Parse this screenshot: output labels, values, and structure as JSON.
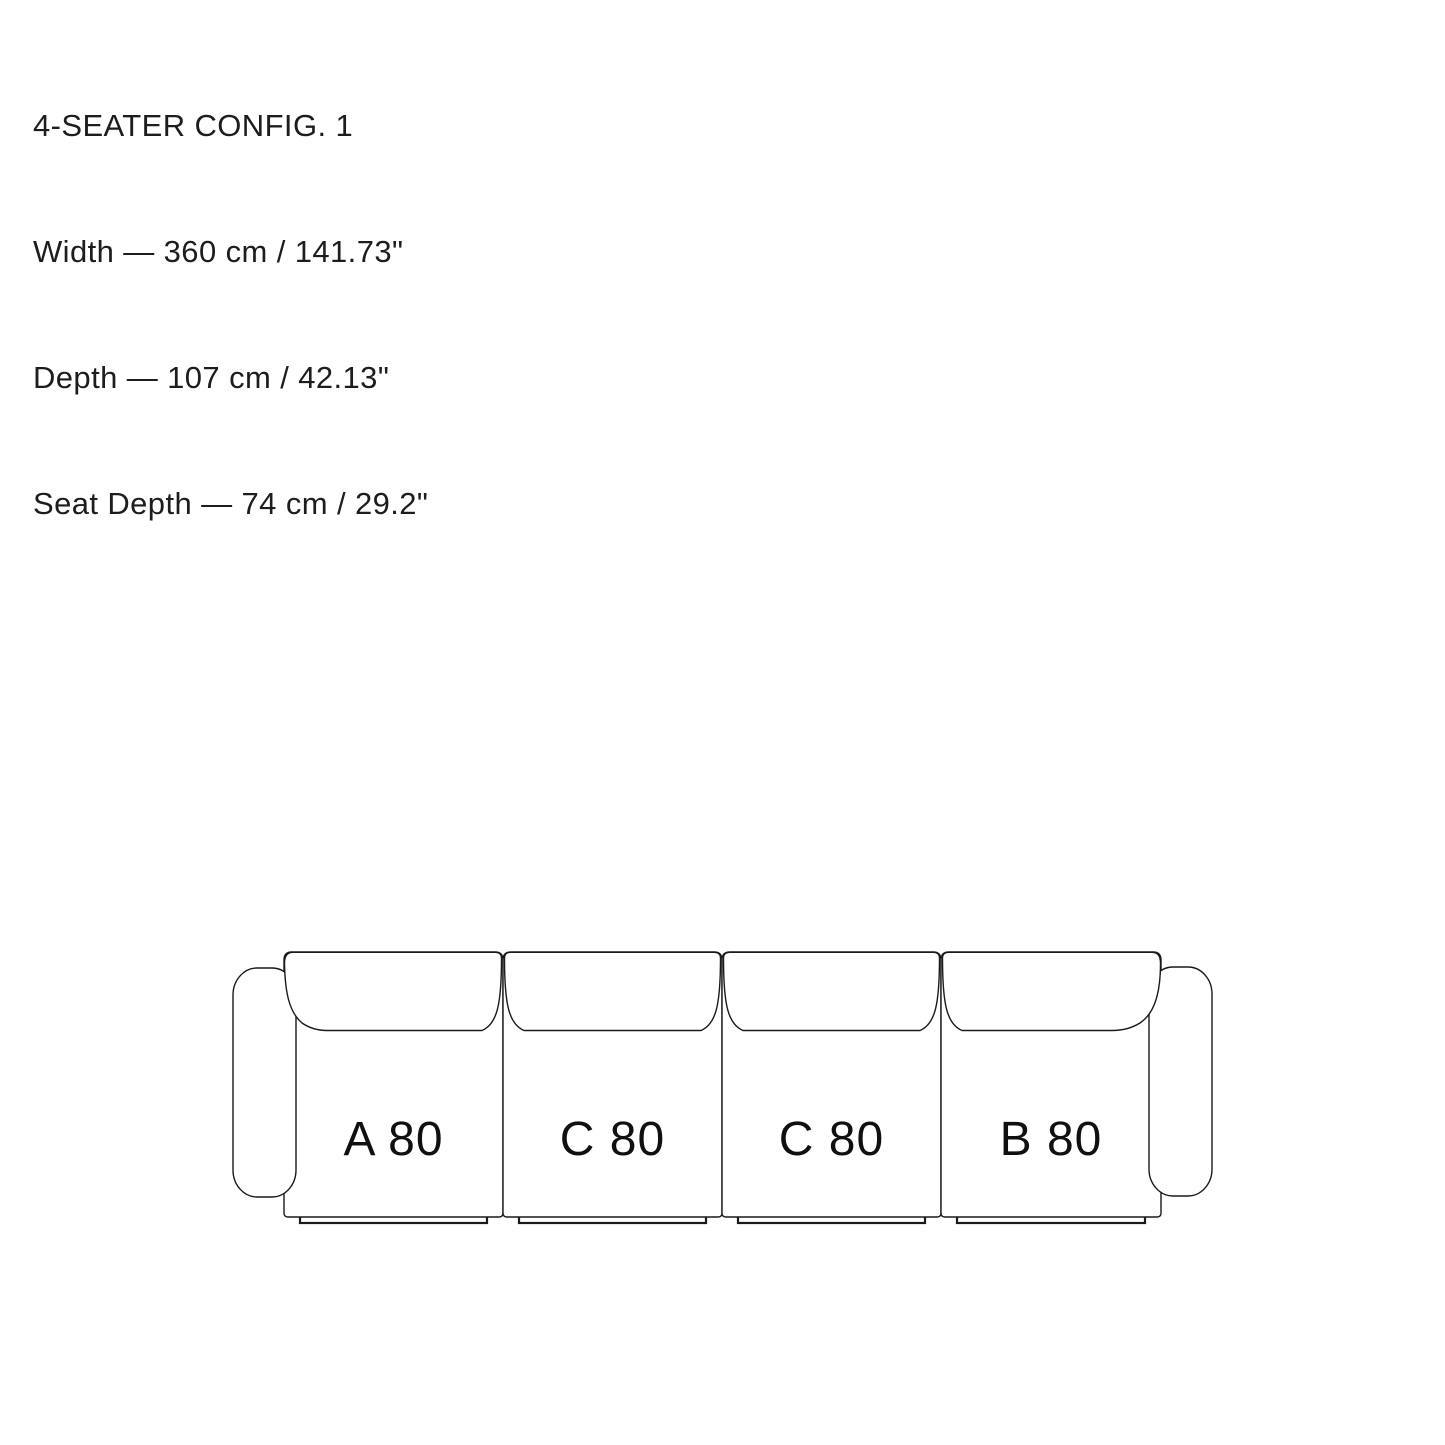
{
  "colors": {
    "background": "#ffffff",
    "line": "#1a1a1a",
    "text": "#1d1d1b"
  },
  "header": {
    "title": "4-SEATER CONFIG. 1",
    "lines": [
      "Width — 360 cm / 141.73\"",
      "Depth — 107 cm / 42.13\"",
      "Seat Depth — 74 cm / 29.2\""
    ]
  },
  "sofa": {
    "modules": [
      {
        "label": "A 80"
      },
      {
        "label": "C 80"
      },
      {
        "label": "C 80"
      },
      {
        "label": "B 80"
      }
    ]
  }
}
